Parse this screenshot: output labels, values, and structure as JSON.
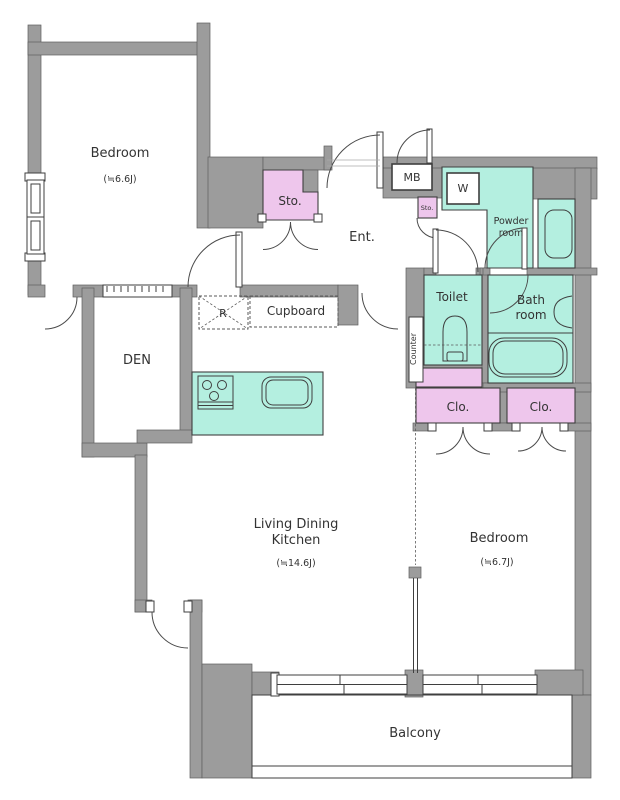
{
  "colors": {
    "wall": "#9c9c9c",
    "wet": "#b4efe0",
    "storage": "#eec6ec",
    "outline": "#3f3f3f",
    "text": "#333333"
  },
  "rooms": {
    "bedroom_top": {
      "name": "Bedroom",
      "size": "(≒6.6J)"
    },
    "bedroom_right": {
      "name": "Bedroom",
      "size": "(≒6.7J)"
    },
    "living": {
      "line1": "Living Dining",
      "line2": "Kitchen",
      "size": "(≒14.6J)"
    },
    "den": {
      "name": "DEN"
    },
    "entrance": {
      "name": "Ent."
    },
    "balcony": {
      "name": "Balcony"
    },
    "powder": {
      "line1": "Powder",
      "line2": "room"
    },
    "toilet": {
      "name": "Toilet"
    },
    "bath": {
      "line1": "Bath",
      "line2": "room"
    }
  },
  "storage": {
    "storage_large": "Sto.",
    "storage_small": "Sto.",
    "closet_left": "Clo.",
    "closet_right": "Clo.",
    "cupboard": "Cupboard",
    "counter": "Counter"
  },
  "equipment": {
    "meter_box": "MB",
    "washer": "W",
    "refrigerator": "R"
  }
}
